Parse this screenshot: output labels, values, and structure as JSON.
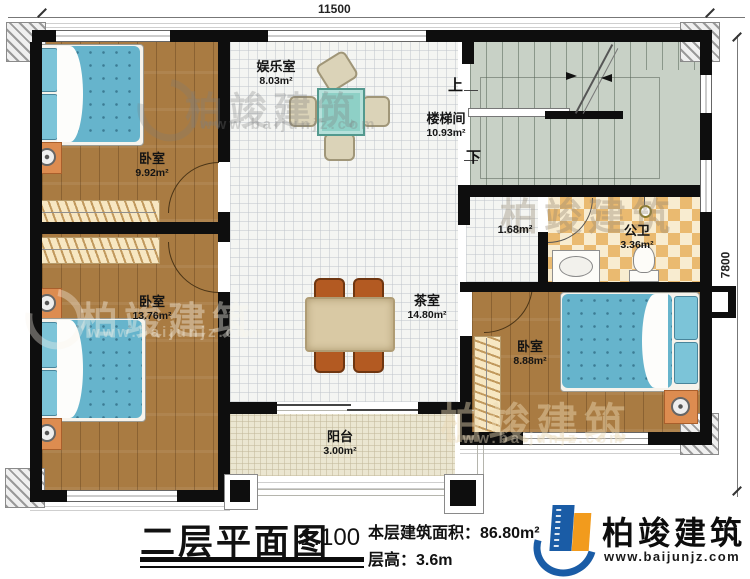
{
  "dimensions": {
    "top": "11500",
    "right": "7800"
  },
  "rooms": {
    "bedroom1": {
      "name": "卧室",
      "area": "9.92m²"
    },
    "bedroom2": {
      "name": "卧室",
      "area": "13.76m²"
    },
    "bedroom3": {
      "name": "卧室",
      "area": "8.88m²"
    },
    "entertainment": {
      "name": "娱乐室",
      "area": "8.03m²"
    },
    "stairwell": {
      "name": "楼梯间",
      "area": "10.93m²"
    },
    "hall": {
      "name": "",
      "area": "1.68m²"
    },
    "bathroom": {
      "name": "公卫",
      "area": "3.36m²"
    },
    "tearoom": {
      "name": "茶室",
      "area": "14.80m²"
    },
    "balcony": {
      "name": "阳台",
      "area": "3.00m²"
    }
  },
  "stairs": {
    "up": "上",
    "down": "下"
  },
  "title_block": {
    "title": "二层平面图",
    "scale": "1:100",
    "floor_area": "本层建筑面积：86.80m²",
    "floor_height": "层高：3.6m"
  },
  "logo": {
    "name": "柏竣建筑",
    "url": "www.baijunjz.com"
  },
  "watermark": {
    "name": "柏竣建筑",
    "url": "www.baijunjz.com"
  },
  "colors": {
    "wall": "#0e0e0e",
    "wood": "#a97b42",
    "bed": "#66b4cc",
    "stair": "#c8d1c6",
    "bath_tile": "#eaba70",
    "balcony": "#ebe6d1",
    "logo_blue": "#1a5ca6",
    "logo_orange": "#f29b1d"
  }
}
